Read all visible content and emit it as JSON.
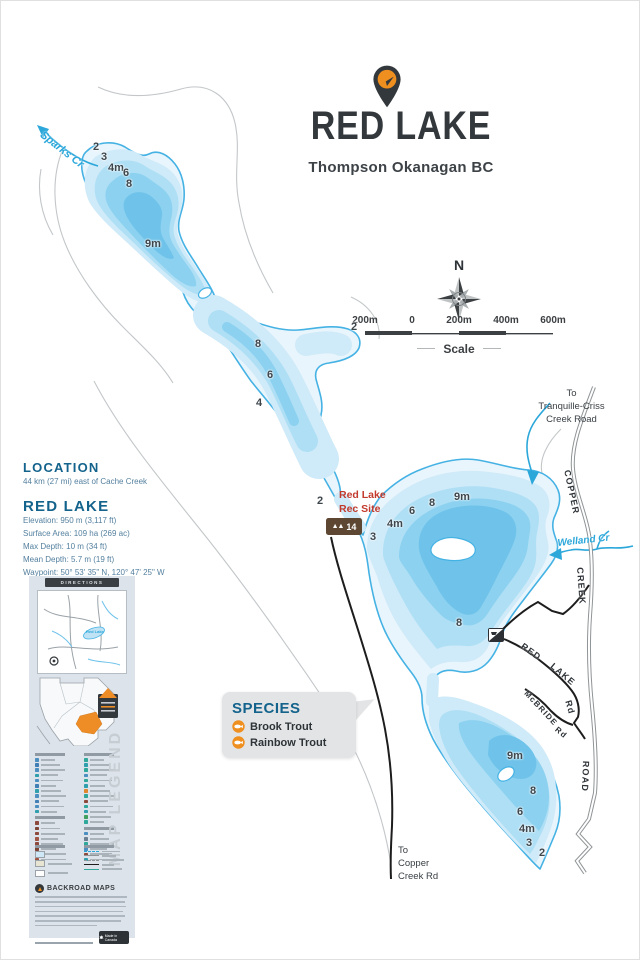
{
  "header": {
    "title": "RED LAKE",
    "subtitle": "Thompson Okanagan BC"
  },
  "compass": {
    "north_label": "N"
  },
  "scale_bar": {
    "ticks": [
      "200m",
      "0",
      "200m",
      "400m",
      "600m"
    ],
    "label": "Scale"
  },
  "location": {
    "heading": "LOCATION",
    "text": "44 km (27 mi) east of Cache Creek"
  },
  "lake_info": {
    "heading": "RED LAKE",
    "lines": [
      "Elevation: 950 m (3,117 ft)",
      "Surface Area: 109 ha (269 ac)",
      "Max Depth: 10 m (34 ft)",
      "Mean Depth: 5.7 m (19 ft)",
      "Waypoint: 50° 53' 35\" N, 120° 47' 25\" W"
    ]
  },
  "species": {
    "heading": "SPECIES",
    "items": [
      "Brook Trout",
      "Rainbow Trout"
    ]
  },
  "map": {
    "creek_labels": {
      "sparks": "Sparks Cr",
      "welland": "Welland Cr"
    },
    "road_labels": {
      "copper": "COPPER",
      "creek": "CREEK",
      "road": "ROAD",
      "red": "RED",
      "lake": "LAKE",
      "rd1": "Rd",
      "mcbride": "McBRIDE",
      "rd2": "Rd"
    },
    "dest_ne": [
      "To",
      "Tranquille-Criss",
      "Creek Road"
    ],
    "dest_s": [
      "To",
      "Copper",
      "Creek Rd"
    ],
    "rec_site": {
      "line1": "Red Lake",
      "line2": "Rec Site",
      "icon_count": "14"
    },
    "depths": [
      "2",
      "3",
      "4m",
      "6",
      "8",
      "9m",
      "8",
      "6",
      "4",
      "2",
      "2",
      "9m",
      "8",
      "6",
      "4m",
      "3",
      "8",
      "9m",
      "8",
      "6",
      "4m",
      "3",
      "2"
    ]
  },
  "sidebar": {
    "directions_label": "DIRECTIONS",
    "inset_label": "Red Lake",
    "map_legend_label": "MAP LEGEND",
    "brand": "BACKROAD MAPS",
    "made_in": "Made in Canada",
    "legend_columns": [
      {
        "groups": [
          {
            "rows": [
              "#4a8fc0",
              "#3f7fb5",
              "#4a8fc0",
              "#2f9fae",
              "#4a8fc0",
              "#3f7fb5",
              "#2f9fae",
              "#4a8fc0",
              "#3f7fb5",
              "#4a8fc0",
              "#2f9fae"
            ]
          },
          {
            "rows": [
              "#8d4a3c",
              "#7d4335",
              "#8d4a3c",
              "#a05544",
              "#8d4a3c",
              "#7d4335",
              "#8d4a3c",
              "#a05544"
            ]
          }
        ]
      },
      {
        "groups": [
          {
            "rows": [
              "#2fa79a",
              "#2f9fae",
              "#2fa79a",
              "#4a8fc0",
              "#2fa79a",
              "#2f9fae",
              "#e0872e",
              "#2fa79a",
              "#8d4a3c",
              "#2fa79a",
              "#2f9fae",
              "#3f9f5f",
              "#2fa79a"
            ]
          },
          {
            "rows": [
              "#4a8fc0",
              "#6a7f8f",
              "#2fa79a",
              "#4a8fc0",
              "#8d4a3c",
              "#2f9fae"
            ]
          }
        ]
      }
    ]
  },
  "colors": {
    "accent_orange": "#ef8f1f",
    "charcoal": "#33383c",
    "teal_heading": "#13638c",
    "lake_outline": "#45b2e4",
    "creek_blue": "#2ba7da",
    "rec_red": "#c23a2c",
    "rec_brown": "#5d4733",
    "info_text": "#54809f"
  }
}
